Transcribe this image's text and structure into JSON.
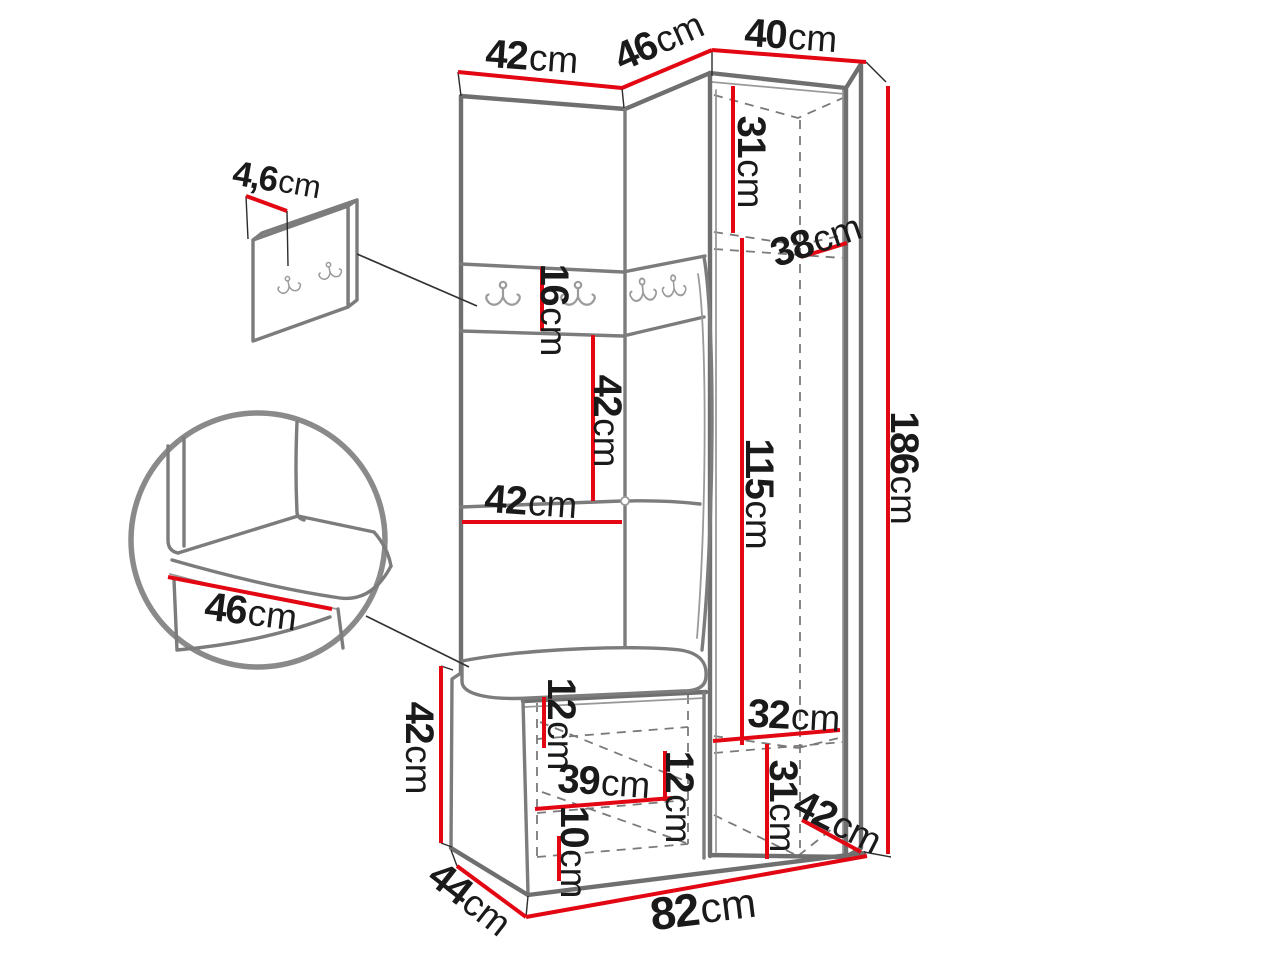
{
  "diagram": {
    "kind": "furniture-dimension-drawing",
    "subject": "hallway corner wardrobe set with bench, hook rail, tall cabinet and wall hook panel",
    "accent_color": "#e30613",
    "line_color": "#7c7c7c",
    "unit_suffix": "cm"
  },
  "dimensions": {
    "left_section_width": {
      "value": "42",
      "unit": "cm"
    },
    "corner_section_width": {
      "value": "46",
      "unit": "cm"
    },
    "cabinet_width": {
      "value": "40",
      "unit": "cm"
    },
    "cabinet_upper_inner_height": {
      "value": "31",
      "unit": "cm"
    },
    "cabinet_inner_depth": {
      "value": "38",
      "unit": "cm"
    },
    "hook_rail_height": {
      "value": "16",
      "unit": "cm"
    },
    "back_panel_height": {
      "value": "42",
      "unit": "cm"
    },
    "back_panel_width": {
      "value": "42",
      "unit": "cm"
    },
    "cabinet_inner_height": {
      "value": "115",
      "unit": "cm"
    },
    "total_height": {
      "value": "186",
      "unit": "cm"
    },
    "hook_panel_thickness": {
      "value": "4,6",
      "unit": "cm"
    },
    "bench_seat_depth": {
      "value": "46",
      "unit": "cm"
    },
    "bench_height": {
      "value": "42",
      "unit": "cm"
    },
    "bench_top_clearance": {
      "value": "12",
      "unit": "cm"
    },
    "bench_inner_width": {
      "value": "39",
      "unit": "cm"
    },
    "bench_shelf_spacing": {
      "value": "12",
      "unit": "cm"
    },
    "bench_bottom_clearance": {
      "value": "10",
      "unit": "cm"
    },
    "cabinet_lower_inner_width": {
      "value": "32",
      "unit": "cm"
    },
    "cabinet_lower_inner_height": {
      "value": "31",
      "unit": "cm"
    },
    "cabinet_depth": {
      "value": "42",
      "unit": "cm"
    },
    "bench_depth": {
      "value": "44",
      "unit": "cm"
    },
    "total_width": {
      "value": "82",
      "unit": "cm"
    }
  }
}
